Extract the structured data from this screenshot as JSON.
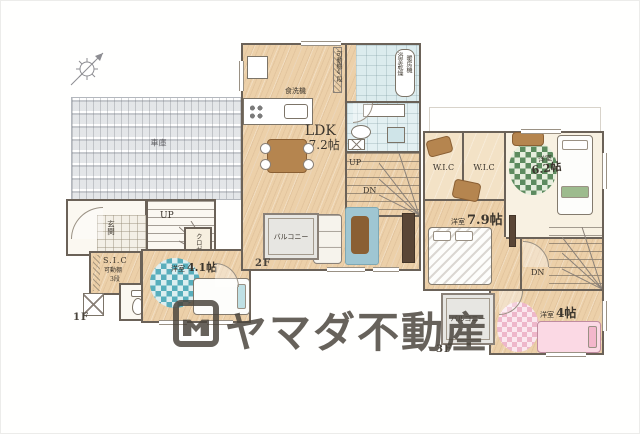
{
  "watermark": {
    "brand": "ヤマダ不動産"
  },
  "floor1": {
    "label": "1F",
    "garage_label": "車庫",
    "entrance_label": "玄関",
    "stairs_up": "UP",
    "closet_label": "クロゼット",
    "sic_label": "S.I.C",
    "sic_shelf": "可動棚",
    "sic_shelf_tiers": "3段",
    "room41_type": "洋室",
    "room41_size": "4.1帖"
  },
  "floor2": {
    "label": "2F",
    "ldk_label": "LDK",
    "ldk_size": "17.2帖",
    "dishwasher_label": "食洗機",
    "pantry_shelf": "可動棚4段",
    "bath_dryer_line1": "浴室乾燥",
    "bath_dryer_line2": "暖房機",
    "stairs_up": "UP",
    "stairs_down": "DN",
    "balcony_label": "バルコニー"
  },
  "floor3": {
    "label": "3F",
    "wic_left": "W.I.C",
    "wic_right": "W.I.C",
    "room62_type": "洋室",
    "room62_size": "6.2帖",
    "room79_type": "洋室",
    "room79_size": "7.9帖",
    "room4_type": "洋室",
    "room4_size": "4帖",
    "stairs_down": "DN",
    "balcony_label": "バルコニー"
  },
  "colors": {
    "wall": "#6b6258",
    "wood_floor": "#ecd0a9",
    "bath_floor": "#dcecee",
    "balcony_floor": "#e7e6e2",
    "rug_teal": "#58aebc",
    "rug_green": "#5d8b5f",
    "rug_pink": "#eeb7ca",
    "watermark_gray": "#4a443c"
  }
}
